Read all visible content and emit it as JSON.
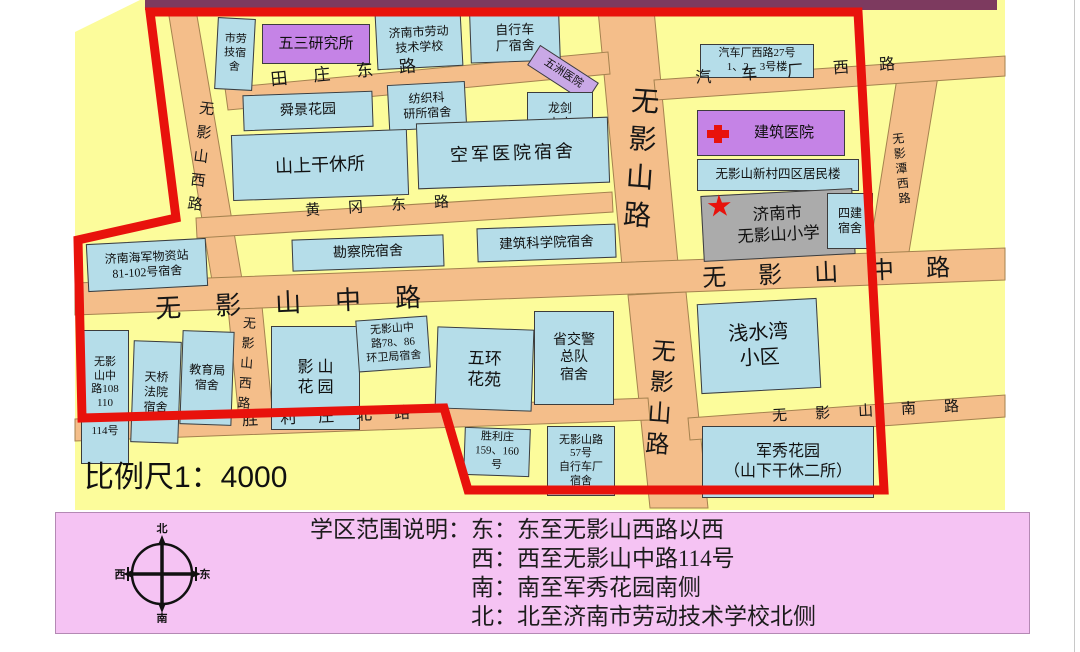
{
  "map": {
    "scale_label": "比例尺1：4000",
    "roads": {
      "tianzhuang_east": "田庄东路",
      "qichechang_west": "汽车厂西路",
      "huanggang_east": "黄冈东路",
      "wuyingshan_middle": "无影山中路",
      "wuyingshan_west": "无影山西路",
      "wuyingshan_road": "无影山路",
      "wuyingtan_west": "无影潭西路",
      "shengli_north": "胜利庄北路",
      "wuyingshan_south": "无影山南路"
    },
    "buildings": [
      "市劳\n技宿\n舍",
      "五三研究所",
      "济南市劳动\n技术学校",
      "自行车\n厂宿舍",
      "汽车厂西路27号\n1、2、3号楼",
      "舜景花园",
      "纺织科\n研所宿舍",
      "五洲医院",
      "龙剑\n山庄",
      "山上干休所",
      "空军医院宿舍",
      "建筑医院",
      "无影山新村四区居民楼",
      "济南市\n无影山小学",
      "四建\n宿舍",
      "勘察院宿舍",
      "建筑科学院宿舍",
      "济南海军物资站\n81-102号宿舍",
      "无影\n山中\n路108\n110\n112\n114号",
      "天桥\n法院\n宿舍",
      "教育局\n宿舍",
      "影 山\n花 园",
      "无影山中\n路78、86\n环卫局宿舍",
      "五环\n花苑",
      "省交警\n总队\n宿舍",
      "浅水湾\n小区",
      "胜利庄\n159、160\n号",
      "无影山路\n57号\n自行车厂\n宿舍",
      "军秀花园\n（山下干休二所）"
    ],
    "colors": {
      "boundary": "#e8120c",
      "road": "#f4be8a",
      "building": "#b5dde9",
      "purple_building": "#c583e6",
      "school_gray": "#ababab",
      "map_bg": "#fcfc9b",
      "legend_bg": "#f5c3f3",
      "top_strip": "#7d3a5f"
    }
  },
  "legend": {
    "title": "学区范围说明：",
    "lines": [
      "东：东至无影山西路以西",
      "西：西至无影山中路114号",
      "南：南至军秀花园南侧",
      "北：北至济南市劳动技术学校北侧"
    ],
    "compass": {
      "north": "北",
      "south": "南",
      "west": "西",
      "east": "东"
    }
  }
}
